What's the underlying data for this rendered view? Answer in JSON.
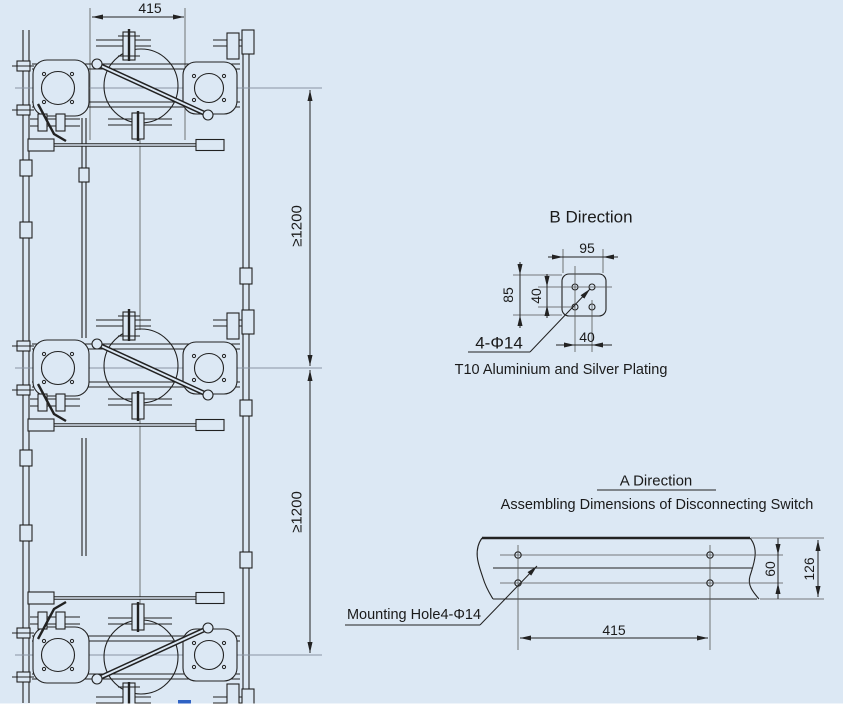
{
  "colors": {
    "background": "#dce8f4",
    "line": "#222222",
    "accent_blue": "#2f62c4"
  },
  "main_view": {
    "dim_top_width": "415",
    "dim_upper_spacing": "≥1200",
    "dim_lower_spacing": "≥1200"
  },
  "b_direction": {
    "title": "B Direction",
    "dim_plate_width": "95",
    "dim_plate_height": "85",
    "dim_hole_spacing_v": "40",
    "dim_hole_spacing_h": "40",
    "holes_label": "4-Φ14",
    "caption": "T10 Aluminium and Silver Plating"
  },
  "a_direction": {
    "title": "A Direction",
    "subtitle": "Assembling Dimensions of Disconnecting Switch",
    "dim_hole_rows": "60",
    "dim_beam_height": "126",
    "dim_hole_span": "415",
    "holes_label": "Mounting Hole4-Φ14"
  }
}
